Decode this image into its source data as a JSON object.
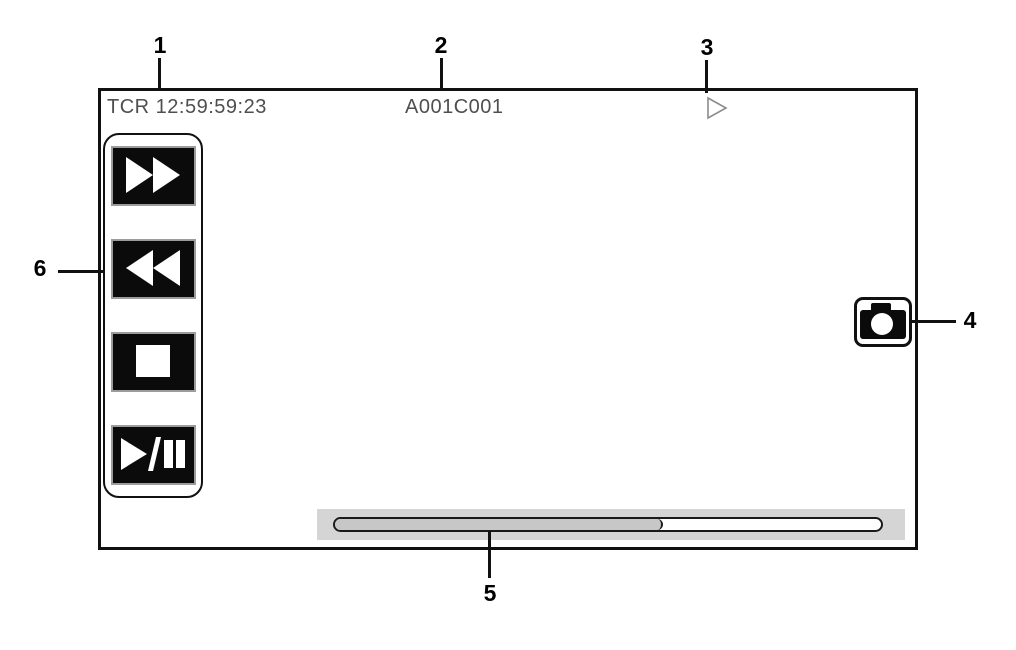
{
  "figure": {
    "screen": {
      "timecode": "TCR 12:59:59:23",
      "clip_name": "A001C001",
      "playback_status_icon": "play-icon"
    },
    "playback_controls": {
      "buttons": [
        {
          "name": "fast-forward",
          "icon": "fast-forward-icon"
        },
        {
          "name": "rewind",
          "icon": "rewind-icon"
        },
        {
          "name": "stop",
          "icon": "stop-icon"
        },
        {
          "name": "play-pause",
          "icon": "play-pause-icon"
        }
      ]
    },
    "photo_button": {
      "icon": "camera-icon"
    },
    "progress_bar": {
      "fill_percent": 60
    },
    "callouts": [
      {
        "label": "1"
      },
      {
        "label": "2"
      },
      {
        "label": "3"
      },
      {
        "label": "4"
      },
      {
        "label": "5"
      },
      {
        "label": "6"
      }
    ]
  },
  "colors": {
    "screen_border": "#111111",
    "screen_text": "#4f4f4f",
    "button_bg": "#0b0b0b",
    "button_border": "#9c9c9c",
    "band_bg": "#d5d5d5",
    "progress_fill": "#c7c7c7",
    "progress_border": "#1a1a1a",
    "status_icon_stroke": "#8c8c8c"
  }
}
